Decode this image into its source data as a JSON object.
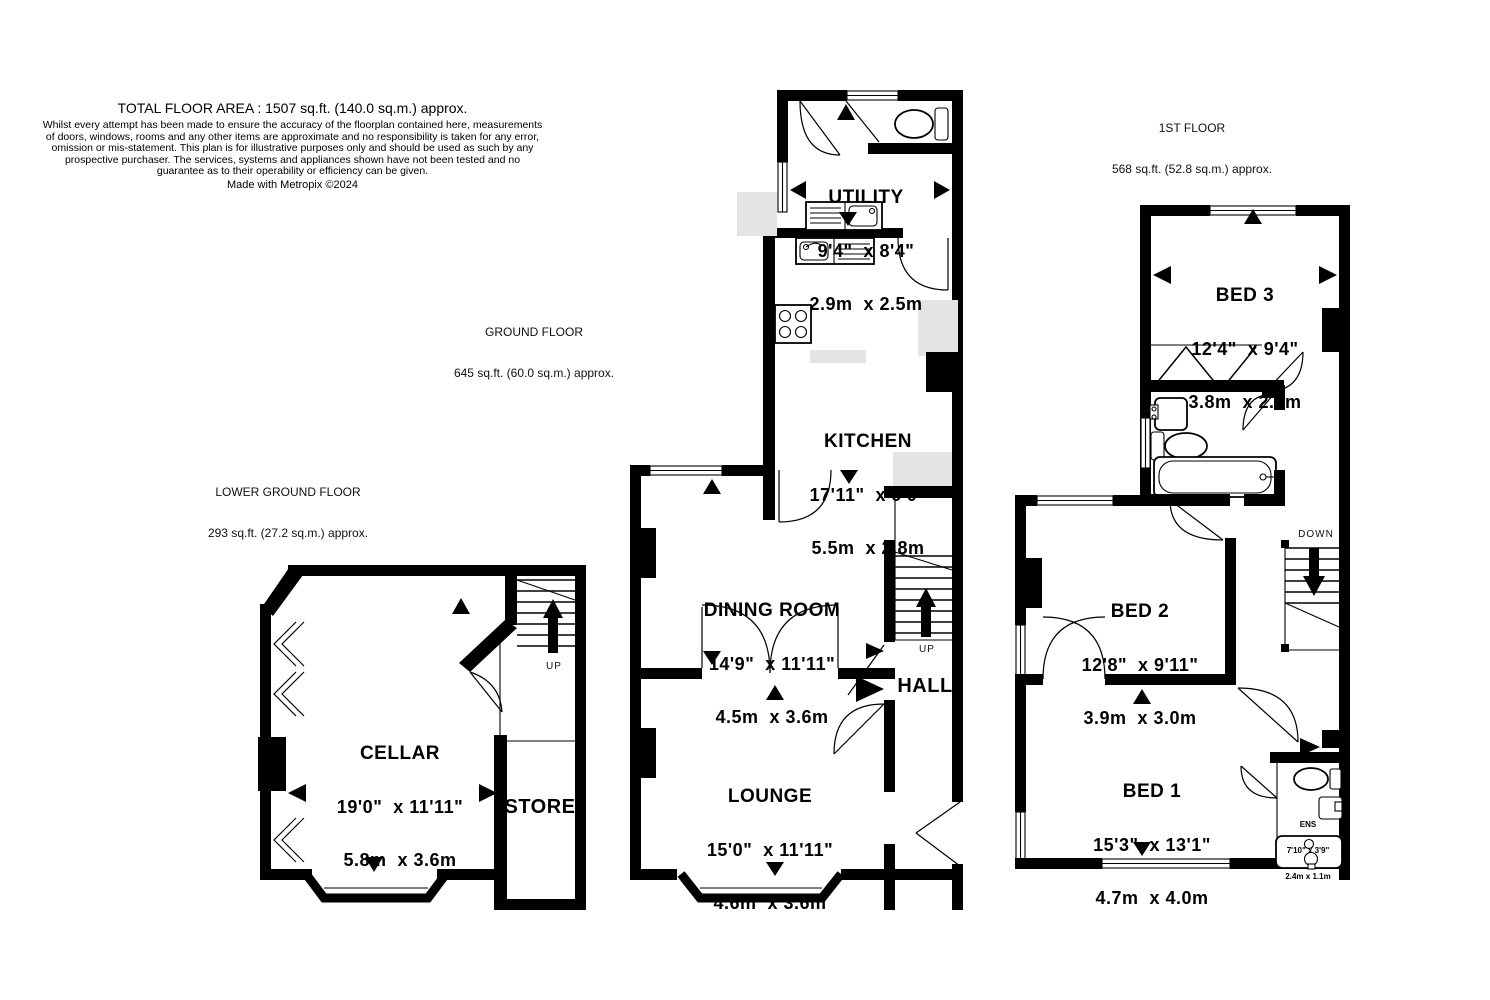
{
  "header": {
    "title": "TOTAL FLOOR AREA : 1507 sq.ft. (140.0 sq.m.) approx.",
    "disclaimer": "Whilst every attempt has been made to ensure the accuracy of the floorplan contained here, measurements of doors, windows, rooms and any other items are approximate and no responsibility is taken for any error, omission or mis-statement. This plan is for illustrative purposes only and should be used as such by any prospective purchaser. The services, systems and appliances shown have not been tested and no guarantee as to their operability or efficiency can be given.",
    "credit": "Made with Metropix ©2024"
  },
  "floors": [
    {
      "id": "lower-ground",
      "title": "LOWER GROUND FLOOR",
      "area": "293 sq.ft. (27.2 sq.m.) approx."
    },
    {
      "id": "ground",
      "title": "GROUND FLOOR",
      "area": "645 sq.ft. (60.0 sq.m.) approx."
    },
    {
      "id": "first",
      "title": "1ST FLOOR",
      "area": "568 sq.ft. (52.8 sq.m.) approx."
    }
  ],
  "rooms": {
    "utility": {
      "name": "UTILITY",
      "imperial": "9'4\"  x 8'4\"",
      "metric": "2.9m  x 2.5m"
    },
    "kitchen": {
      "name": "KITCHEN",
      "imperial": "17'11\"  x 9'0\"",
      "metric": "5.5m  x 2.8m"
    },
    "dining": {
      "name": "DINING ROOM",
      "imperial": "14'9\"  x 11'11\"",
      "metric": "4.5m  x 3.6m"
    },
    "lounge": {
      "name": "LOUNGE",
      "imperial": "15'0\"  x 11'11\"",
      "metric": "4.6m  x 3.6m"
    },
    "cellar": {
      "name": "CELLAR",
      "imperial": "19'0\"  x 11'11\"",
      "metric": "5.8m  x 3.6m"
    },
    "bed1": {
      "name": "BED 1",
      "imperial": "15'3\"  x 13'1\"",
      "metric": "4.7m  x 4.0m"
    },
    "bed2": {
      "name": "BED 2",
      "imperial": "12'8\"  x 9'11\"",
      "metric": "3.9m  x 3.0m"
    },
    "bed3": {
      "name": "BED 3",
      "imperial": "12'4\"  x 9'4\"",
      "metric": "3.8m  x 2.9m"
    },
    "ens": {
      "name": "ENS",
      "imperial": "7'10\" x 3'9\"",
      "metric": "2.4m x 1.1m"
    }
  },
  "annotations": {
    "hall": "HALL",
    "store": "STORE",
    "up": "UP",
    "down": "DOWN"
  },
  "colors": {
    "wall": "#000000",
    "counter_shading": "#e4e4e4",
    "background": "#ffffff"
  }
}
